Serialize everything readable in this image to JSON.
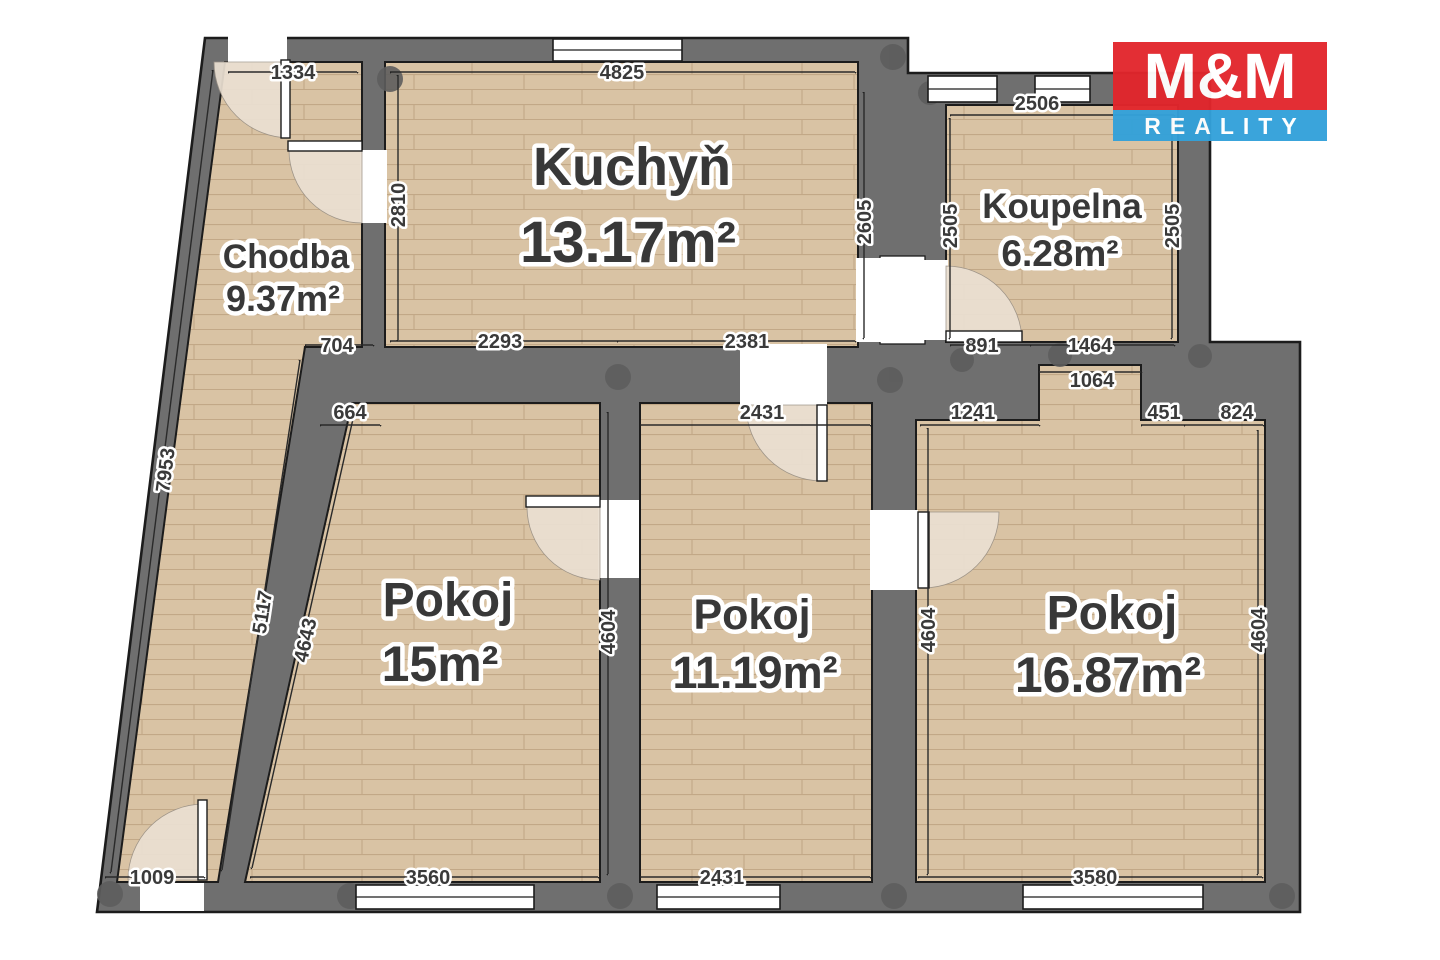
{
  "plan": {
    "rooms": [
      {
        "id": "chodba",
        "name": "Chodba",
        "area": "9.37m²"
      },
      {
        "id": "kuchyn",
        "name": "Kuchyň",
        "area": "13.17m²"
      },
      {
        "id": "koupelna",
        "name": "Koupelna",
        "area": "6.28m²"
      },
      {
        "id": "pokoj-15",
        "name": "Pokoj",
        "area": "15m²"
      },
      {
        "id": "pokoj-11",
        "name": "Pokoj",
        "area": "11.19m²"
      },
      {
        "id": "pokoj-16",
        "name": "Pokoj",
        "area": "16.87m²"
      }
    ],
    "dimensions_mm": {
      "top_chodba": "1334",
      "top_kuchyn": "4825",
      "top_koupelna": "2506",
      "kuchyn_left": "2810",
      "kuchyn_right": "2605",
      "koupelna_left": "2505",
      "koupelna_right": "2505",
      "wall_chodba_kuchyn": "704",
      "kuchyn_bottom_left": "2293",
      "kuchyn_bottom_right": "2381",
      "koupelna_bottom_left": "891",
      "koupelna_bottom_right": "1464",
      "nika": "1064",
      "pokoj15_top": "664",
      "pokoj11_top": "2431",
      "pokoj16_top_left": "1241",
      "pokoj16_top_mid": "451",
      "pokoj16_top_right": "824",
      "chodba_outer": "7953",
      "chodba_inner": "5117",
      "pokoj15_left": "4643",
      "pokoj15_right": "4604",
      "pokoj11_right": "4604",
      "pokoj16_right": "4604",
      "chodba_door": "1009",
      "pokoj15_bottom": "3560",
      "pokoj11_bottom": "2431",
      "pokoj16_bottom": "3580"
    }
  },
  "logo": {
    "title": "M&M",
    "subtitle": "REALITY"
  },
  "colors": {
    "floor": "#d9c3a4",
    "floor_line": "#c2a887",
    "wall": "#6f6f6f",
    "wall_joint": "#5d5d5d",
    "outline": "#1c1c1c",
    "door_arc": "#ebe0d2",
    "logo_red": "#e2262c",
    "logo_blue": "#33a1da"
  }
}
